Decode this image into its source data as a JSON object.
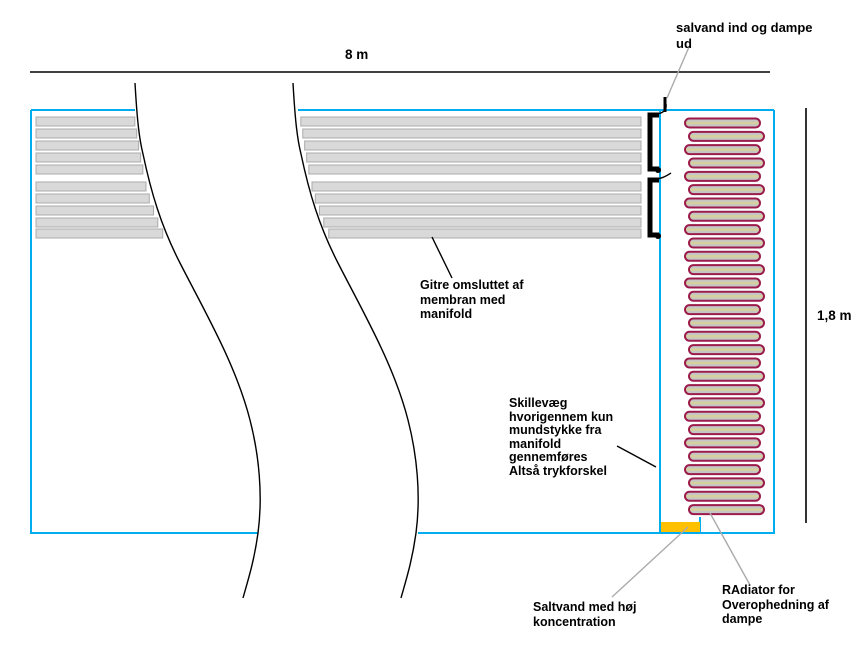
{
  "dimension_labels": {
    "width": "8 m",
    "height": "1,8 m"
  },
  "annotations": {
    "inlet": [
      "salvand ind og dampe",
      "ud"
    ],
    "grids": [
      "Gitre omsluttet af",
      "membran med",
      "manifold"
    ],
    "partition": [
      "Skillevæg",
      "hvorigennem kun",
      "mundstykke fra",
      "manifold",
      "gennemføres",
      "Altså trykforskel"
    ],
    "saltwater": [
      "Saltvand med høj",
      "koncentration"
    ],
    "radiator": [
      "RAdiator for",
      "Overophedning af",
      "dampe"
    ]
  },
  "diagram": {
    "colors": {
      "tank": "#00AEEF",
      "grid_fill": "#D9D9D9",
      "grid_border": "#ABABAB",
      "tube_border": "#9B1B4B",
      "tube_gray": "#C6C6C6",
      "tube_tan": "#D6D09E",
      "saltwater": "#FFC000",
      "pointer_gray": "#ABABAB",
      "ink": "#000000"
    },
    "grid_bar_groups": 2,
    "grid_bars_per_group": 5,
    "radiator_tube_count": 30
  }
}
